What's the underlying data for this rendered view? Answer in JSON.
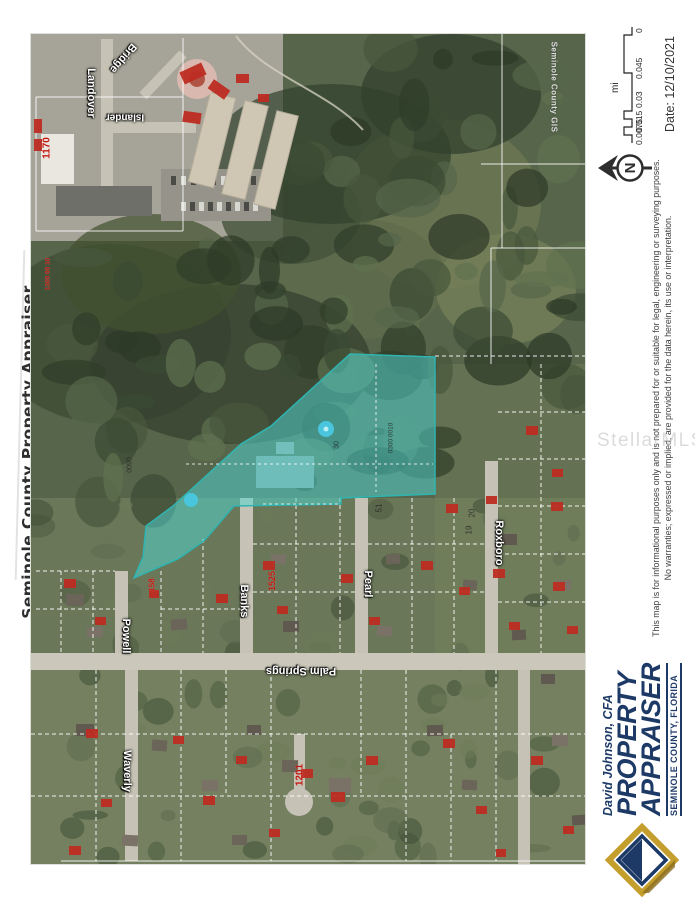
{
  "page": {
    "vertical_title": "Seminole County Property Appraiser",
    "watermark": "StellarMLS"
  },
  "map": {
    "credit": "Seminole County GIS",
    "streets": [
      "Landover",
      "Bridge",
      "Islander",
      "Powell",
      "Banks",
      "Pearl",
      "Roxboro",
      "Waverly",
      "Palm Springs"
    ],
    "parcel_numbers": [
      "1170",
      "1300 00 10",
      "1525",
      "158",
      "1201"
    ],
    "lot_numbers": [
      "20",
      "19",
      "51",
      "0090",
      "30",
      "0300 0010"
    ],
    "highlight_color": "#4fd6d2"
  },
  "sidebar": {
    "scalebar": {
      "unit": "mi",
      "labels": [
        "0.0075",
        "0.015",
        "0.03",
        "0.045",
        "0"
      ]
    },
    "date": "Date: 12/10/2021",
    "north": "N",
    "disclaimer_line1": "This map is for informational purposes only and is not prepared for or suitable for legal, engineering or surveying purposes.",
    "disclaimer_line2": "No warranties; expressed or implied, are provided for the data herein, its use or interpretation.",
    "logo": {
      "name": "David Johnson, CFA",
      "title1": "PROPERTY",
      "title2": "APPRAISER",
      "subtitle": "SEMINOLE COUNTY, FLORIDA"
    }
  }
}
